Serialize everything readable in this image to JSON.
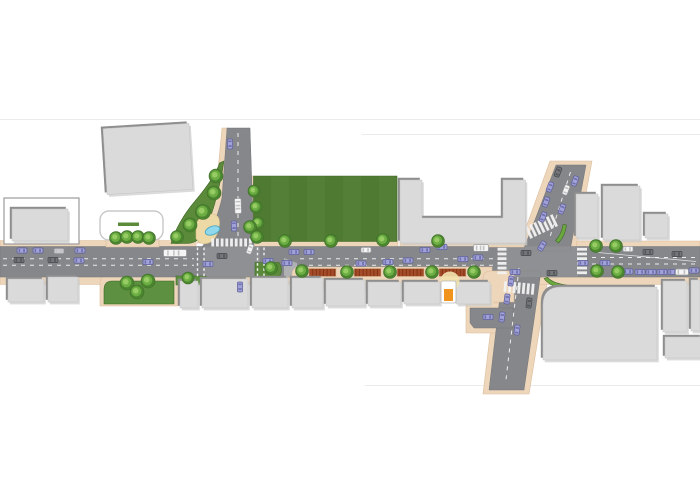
{
  "colors": {
    "road": "#85878a",
    "roadEdge": "#74767a",
    "roadLight": "#9a9c9e",
    "island": "#aeb0b2",
    "sidewalk": "#eed6ba",
    "sidewalkEdge": "#ddbd9c",
    "sand": "#ecd9a6",
    "sandEdge": "#d8bd86",
    "building": "#dadada",
    "buildingEdge": "#c2c2c2",
    "roofShadow": "#8e8e8e",
    "softShadow": "#cccccc",
    "parkA": "#4e7a31",
    "parkB": "#547f36",
    "parkEdge": "#42682a",
    "green": "#5a8a3a",
    "arcGreen": "#6aa73e",
    "lawn": "#5d9040",
    "treeOuter": "#4c8530",
    "treeMid": "#6cae43",
    "treeInner": "#97cb64",
    "treeEdge": "#3e6f27",
    "pond": "#90d9ec",
    "pondEdge": "#4aa7c4",
    "planter": "#a64b27",
    "planterLine": "#7e3519",
    "planterEdge": "#d8b894",
    "marking": "#f2f2f2",
    "seam": "#ebebeb",
    "white": "#ffffff",
    "kioskOrange": "#f0941e",
    "kioskFrame": "#b5b5b5",
    "plazaCircle": "#f2e2ae",
    "carLav": "#a2a2da",
    "carLavEdge": "#5e5e97",
    "glassLav": "#7070ab",
    "carDark": "#73757a",
    "carDarkEdge": "#46484c",
    "glassDark": "#54565a",
    "carWhite": "#f5f5f5",
    "carWhiteEdge": "#98989b",
    "glassWhite": "#c2c2c5",
    "carGray": "#c9c9cc",
    "carGrayEdge": "#909095",
    "shelterEdge": "#c8c8c8",
    "parcelEdge": "#9b9b9b"
  },
  "scene": {
    "canvas": {
      "w": 700,
      "h": 500
    },
    "seams": [
      {
        "x1": 0,
        "y1": 119.5,
        "x2": 700,
        "y2": 119.5
      },
      {
        "x1": 362,
        "y1": 134.5,
        "x2": 700,
        "y2": 134.5
      },
      {
        "x1": 365,
        "y1": 385.5,
        "x2": 700,
        "y2": 385.5
      }
    ],
    "sidewalks_under": [
      {
        "d": "M0,240.5 H196 V247 H0 Z"
      },
      {
        "d": "M248,176 H253.5 V241.5 H398 V247 H248 Z"
      },
      {
        "d": "M400,241.5 H526 V247 H400 Z"
      },
      {
        "d": "M556,241 H700 V247 H556 Z"
      },
      {
        "d": "M550,161 L592,161 L576,247 L519,247 Z"
      },
      {
        "d": "M497,277 L548,277 L529,394 L483,394 Z"
      },
      {
        "d": "M466,303 H514 V333 H466 Z"
      },
      {
        "d": "M0,277 H296 V284.5 H0 Z"
      },
      {
        "d": "M480,277 H700 V284.5 H480 Z"
      },
      {
        "d": "M100,306 V283 Q100,275.5 108,275.5 H178 V306 Z"
      },
      {
        "d": "M222,128 H228 L221,203 Q214,226 204,243 L197,243 Q207,226 215,203 Z"
      }
    ],
    "roads": [
      {
        "d": "M0,246.5 H700 V277 H0 Z"
      },
      {
        "d": "M227,128 L250,128 L254,247 L202,247 C211,235 218.5,213 222,198 Z"
      },
      {
        "d": "M556,165 L586,165 L570,251 L523,251 Z"
      },
      {
        "d": "M503,271 L541,271 L524,390 L489,390 Z"
      },
      {
        "d": "M470,308 H513 V328 H474 L470,323 Z"
      }
    ],
    "patches": [
      {
        "d": "M204,246.5 H260 V277 H204 Z"
      },
      {
        "d": "M498,246.5 H578 V277 H498 Z"
      }
    ],
    "islands": [
      {
        "d": "M284,258 L297,263 L297,277 L284,277 Z"
      }
    ],
    "sidewalks_over": [
      {
        "d": "M106,247 V239 Q106,232.5 113,232.5 H152 Q159,232.5 159,239 V247 Z"
      },
      {
        "d": "M481,247 V240 Q481,232.5 489,232.5 H524 V247 Z"
      },
      {
        "d": "M292,290 V275 Q292,267 300,267 H492 V290 Z"
      },
      {
        "d": "M483,302 V279 Q483,271 491,271 H514 V302 Z"
      }
    ],
    "greens": [
      {
        "d": "M253.5,176 H397 V241.5 H253.5 Z",
        "f": "park"
      },
      {
        "d": "M224,161 C221,182 214,210 205.5,230 C201.5,239 195,243.5 186,243.5 L171,243.5 C174.5,231 183,215 195.5,200.5 C206,188 216.5,173 219.5,163 Z",
        "f": "green"
      },
      {
        "d": "M104,304 V290 Q104,281 112,281 H174 V304 Z",
        "f": "lawn"
      },
      {
        "d": "M176,276 H206 V285 H176 Z",
        "f": "lawn"
      },
      {
        "d": "M255,262.5 H279 Q284,270 279,277 H255 Z",
        "f": "green"
      },
      {
        "d": "M494,239.5 Q506,228.5 522,230 L521.5,234 Q508,233 497.5,241.5 Z",
        "f": "arc"
      },
      {
        "d": "M558.5,243 Q565.5,235.5 566.5,225 L563,224.5 Q561.5,234.5 555.5,240.5 Z",
        "f": "arc"
      },
      {
        "d": "M544,278.5 Q550.5,287.5 566,288.5 L566.5,285 Q553.5,283.5 547.5,277.5 Z",
        "f": "arc"
      }
    ],
    "sand": {
      "d": "M196,224 Q201,213.5 212,214 Q220,214.5 219.5,224 Q219,234 212.5,241 Q202,247.5 196,238.5 Z"
    },
    "pond": {
      "cx": 212.5,
      "cy": 230.5,
      "rx": 7.5,
      "ry": 4.2,
      "rot": -20
    },
    "lane_dashes": [
      {
        "x1": 3,
        "y1": 258.8,
        "x2": 194,
        "y2": 258.8
      },
      {
        "x1": 3,
        "y1": 265.2,
        "x2": 194,
        "y2": 265.2
      },
      {
        "x1": 300,
        "y1": 258.8,
        "x2": 494,
        "y2": 258.8
      },
      {
        "x1": 300,
        "y1": 265.2,
        "x2": 494,
        "y2": 265.2
      },
      {
        "x1": 592,
        "y1": 257.5,
        "x2": 698,
        "y2": 257.5
      },
      {
        "x1": 592,
        "y1": 264,
        "x2": 698,
        "y2": 264
      },
      {
        "x1": 238,
        "y1": 133,
        "x2": 238,
        "y2": 236
      },
      {
        "x1": 570.5,
        "y1": 172,
        "x2": 549,
        "y2": 240
      },
      {
        "x1": 519,
        "y1": 268,
        "x2": 505.5,
        "y2": 384
      }
    ],
    "solid_lines": [
      {
        "x1": 598,
        "y1": 252.5,
        "x2": 696,
        "y2": 261.5
      }
    ],
    "transverse_crosswalks": [
      {
        "x": 197.5,
        "y1": 247.5,
        "y2": 276.5
      },
      {
        "x": 204,
        "y1": 247.5,
        "y2": 276.5
      },
      {
        "x": 257.5,
        "y1": 247.5,
        "y2": 276.5
      },
      {
        "x": 264,
        "y1": 247.5,
        "y2": 276.5
      }
    ],
    "zebras": [
      {
        "tx": 231.5,
        "ty": 242.5,
        "rot": 0,
        "dir": "x",
        "count": 9,
        "step": 4.7,
        "w": 2.8,
        "h": 8
      },
      {
        "tx": 502,
        "ty": 261,
        "rot": 0,
        "dir": "y",
        "count": 6,
        "step": 4.7,
        "w": 9,
        "h": 2.8
      },
      {
        "tx": 582,
        "ty": 261,
        "rot": 0,
        "dir": "y",
        "count": 6,
        "step": 4.7,
        "w": 10,
        "h": 2.8
      },
      {
        "tx": 541.5,
        "ty": 226.5,
        "rot": -25,
        "dir": "x",
        "count": 7,
        "step": 4.6,
        "w": 2.8,
        "h": 13
      },
      {
        "tx": 519,
        "ty": 288,
        "rot": 5,
        "dir": "x",
        "count": 7,
        "step": 4.6,
        "w": 2.8,
        "h": 11
      }
    ],
    "planters": [
      {
        "x": 309,
        "y": 268.5,
        "w": 27,
        "h": 8
      },
      {
        "x": 354,
        "y": 268.5,
        "w": 27,
        "h": 8
      },
      {
        "x": 397,
        "y": 268.5,
        "w": 27,
        "h": 8
      },
      {
        "x": 439,
        "y": 268.5,
        "w": 27,
        "h": 8
      }
    ],
    "buildings": [
      {
        "kind": "outline",
        "x": 4,
        "y": 198,
        "w": 75,
        "h": 46
      },
      {
        "kind": "box",
        "x": 12,
        "y": 209,
        "w": 56,
        "h": 32
      },
      {
        "kind": "box",
        "x": 105,
        "y": 126,
        "w": 86,
        "h": 66,
        "rot": -3.5
      },
      {
        "kind": "shelter",
        "x": 100,
        "y": 211,
        "w": 63,
        "h": 29,
        "bar": [
          118,
          222.5,
          21,
          3.5
        ]
      },
      {
        "kind": "pathb",
        "d": "M400,180 H422 V218 H503 V180 H525.5 V243 H400 Z"
      },
      {
        "kind": "box",
        "x": 576,
        "y": 194,
        "w": 22,
        "h": 44
      },
      {
        "kind": "box",
        "x": 603,
        "y": 186,
        "w": 37,
        "h": 54
      },
      {
        "kind": "box",
        "x": 645,
        "y": 214,
        "w": 23,
        "h": 24
      },
      {
        "kind": "box",
        "x": 8,
        "y": 279,
        "w": 36,
        "h": 23
      },
      {
        "kind": "box",
        "x": 48,
        "y": 277,
        "w": 30,
        "h": 25
      },
      {
        "kind": "box",
        "x": 180,
        "y": 281,
        "w": 18,
        "h": 27
      },
      {
        "kind": "box",
        "x": 202,
        "y": 279,
        "w": 46,
        "h": 29
      },
      {
        "kind": "box",
        "x": 252,
        "y": 278,
        "w": 36,
        "h": 30
      },
      {
        "kind": "box",
        "x": 292,
        "y": 278,
        "w": 31,
        "h": 30
      },
      {
        "kind": "box",
        "x": 326,
        "y": 280,
        "w": 39,
        "h": 26
      },
      {
        "kind": "box",
        "x": 368,
        "y": 282,
        "w": 33,
        "h": 24
      },
      {
        "kind": "box",
        "x": 404,
        "y": 282,
        "w": 36,
        "h": 22
      },
      {
        "kind": "box",
        "x": 456,
        "y": 282,
        "w": 34,
        "h": 22
      },
      {
        "kind": "pathb",
        "d": "M543,360 V305 Q543,287 561,287 H657 V360 Z"
      },
      {
        "kind": "box",
        "x": 663,
        "y": 281,
        "w": 24,
        "h": 51
      },
      {
        "kind": "box",
        "x": 691,
        "y": 280,
        "w": 9,
        "h": 51
      },
      {
        "kind": "box",
        "x": 665,
        "y": 337,
        "w": 37,
        "h": 21
      }
    ],
    "kiosk": {
      "x": 441,
      "y": 281,
      "w": 15,
      "h": 22,
      "orange": [
        444,
        289,
        9,
        12
      ],
      "circle": [
        450,
        281,
        9.5
      ]
    },
    "trees": [
      [
        216,
        176,
        7
      ],
      [
        214,
        193,
        7
      ],
      [
        203,
        212,
        7.5
      ],
      [
        190,
        225,
        7
      ],
      [
        177,
        237,
        6.5
      ],
      [
        254,
        191,
        6
      ],
      [
        256,
        207,
        6
      ],
      [
        258,
        223,
        6
      ],
      [
        250,
        227,
        6.5
      ],
      [
        257,
        237,
        6.5
      ],
      [
        116,
        238,
        6.5
      ],
      [
        127,
        237,
        6.5
      ],
      [
        138,
        237,
        6.5
      ],
      [
        149,
        238,
        6.5
      ],
      [
        127,
        283,
        7
      ],
      [
        148,
        281,
        7
      ],
      [
        137,
        292,
        7
      ],
      [
        188,
        278,
        6
      ],
      [
        271,
        268,
        6.5
      ],
      [
        285,
        241,
        6.5
      ],
      [
        331,
        241,
        6.5
      ],
      [
        383,
        240,
        6.5
      ],
      [
        438,
        241,
        6.5
      ],
      [
        302,
        271,
        6.5
      ],
      [
        347,
        272,
        6.5
      ],
      [
        390,
        272,
        6.5
      ],
      [
        432,
        272,
        6.5
      ],
      [
        474,
        272,
        6.5
      ],
      [
        596,
        246,
        6.5
      ],
      [
        616,
        246,
        6.5
      ],
      [
        597,
        271,
        6.5
      ],
      [
        618,
        272,
        6.5
      ]
    ],
    "vehicles": [
      [
        22,
        250.5,
        0,
        "lav"
      ],
      [
        38,
        250.5,
        0,
        "lav"
      ],
      [
        59,
        251,
        0,
        "gray"
      ],
      [
        80,
        250.5,
        0,
        "lav"
      ],
      [
        19,
        260,
        0,
        "dark"
      ],
      [
        53,
        260,
        0,
        "dark"
      ],
      [
        79,
        260.5,
        0,
        "lav"
      ],
      [
        148,
        262,
        0,
        "lav"
      ],
      [
        175,
        253,
        0,
        "bus"
      ],
      [
        208,
        264,
        0,
        "lav"
      ],
      [
        222,
        256,
        0,
        "dark"
      ],
      [
        250,
        249,
        -70,
        "white"
      ],
      [
        240,
        287,
        90,
        "lav"
      ],
      [
        230,
        144,
        88,
        "lav"
      ],
      [
        238,
        206,
        88,
        "truck"
      ],
      [
        234,
        226,
        88,
        "lav"
      ],
      [
        294,
        252,
        0,
        "lav"
      ],
      [
        309,
        252,
        0,
        "lav"
      ],
      [
        366,
        250,
        0,
        "white"
      ],
      [
        425,
        250,
        0,
        "lav"
      ],
      [
        442,
        247,
        0,
        "lav"
      ],
      [
        481,
        248,
        0,
        "truck"
      ],
      [
        268,
        261,
        0,
        "lav"
      ],
      [
        287,
        263,
        0,
        "lav"
      ],
      [
        361,
        263.5,
        0,
        "lav"
      ],
      [
        388,
        262,
        0,
        "lav"
      ],
      [
        408,
        260.5,
        0,
        "lav"
      ],
      [
        463,
        259,
        0,
        "lav"
      ],
      [
        478,
        257.5,
        0,
        "lav"
      ],
      [
        526,
        253,
        0,
        "dark"
      ],
      [
        542,
        246,
        -60,
        "lav"
      ],
      [
        515,
        272,
        0,
        "lav"
      ],
      [
        552,
        273,
        0,
        "dark"
      ],
      [
        550,
        187,
        -69,
        "lav"
      ],
      [
        546,
        202,
        -69,
        "lav"
      ],
      [
        543,
        217,
        -69,
        "lav"
      ],
      [
        558,
        172,
        -69,
        "dark"
      ],
      [
        575,
        181,
        -69,
        "lav"
      ],
      [
        566,
        190,
        -69,
        "white"
      ],
      [
        562,
        209,
        -69,
        "lav"
      ],
      [
        511,
        281,
        -83,
        "lav"
      ],
      [
        507,
        299,
        -83,
        "lav"
      ],
      [
        502,
        317,
        -83,
        "lav"
      ],
      [
        517,
        330,
        -83,
        "lav"
      ],
      [
        488,
        317,
        0,
        "lav"
      ],
      [
        529,
        303,
        -83,
        "dark"
      ],
      [
        628,
        249,
        0,
        "white"
      ],
      [
        648,
        252,
        0,
        "dark"
      ],
      [
        677,
        254,
        0,
        "dark"
      ],
      [
        583,
        263,
        0,
        "lav"
      ],
      [
        605,
        263,
        0,
        "lav"
      ],
      [
        628,
        271.5,
        0,
        "lav"
      ],
      [
        640,
        272,
        0,
        "lav"
      ],
      [
        651,
        272,
        0,
        "lav"
      ],
      [
        662,
        272,
        0,
        "lav"
      ],
      [
        673,
        272,
        0,
        "lav"
      ],
      [
        682,
        272,
        0,
        "van"
      ],
      [
        694,
        270.5,
        0,
        "lav"
      ]
    ]
  }
}
